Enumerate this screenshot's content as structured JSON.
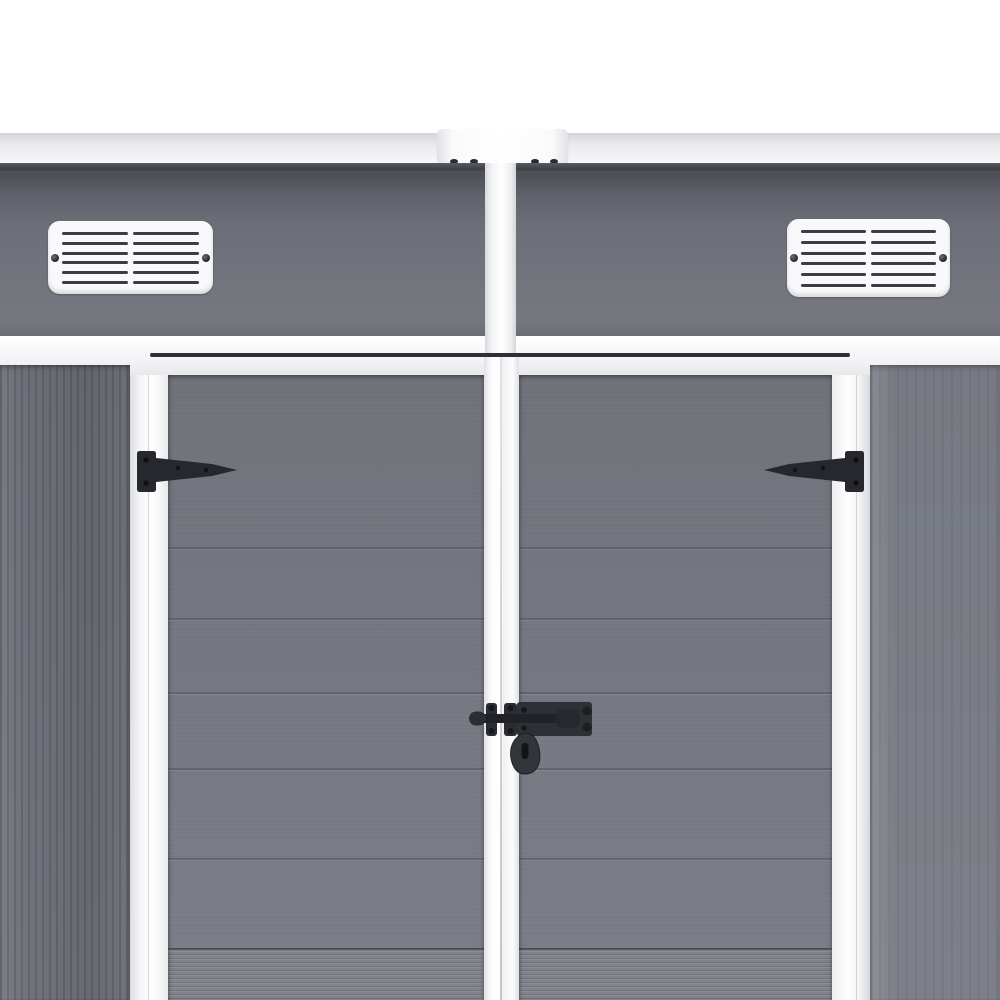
{
  "scene": {
    "subject": "garden-storage-shed-front",
    "view": "close-up of white-framed grey double doors with roof edge, two louvred vents, black tee hinges and black pad-bolt latch"
  },
  "colors": {
    "background": "#ffffff",
    "roof_strip_top": "#d6d6da",
    "roof_strip_bottom": "#f8f8fa",
    "connector_plate": "#fbfbfd",
    "shadow_line": "#3e4046",
    "upper_band_top": "#666972",
    "upper_band_bottom": "#75787f",
    "door_grey_top": "#6f7279",
    "door_grey_bottom": "#7b7e86",
    "trim_white": "#f8f8fa",
    "vent_white": "#f9f9fb",
    "vent_slat": "#3b3d41",
    "hardware_black": "#2a2c31",
    "hardware_dark": "#131417"
  },
  "roof": {
    "connector_screw_count": 4
  },
  "vents": {
    "count": 2,
    "slat_rows": 6,
    "slat_columns": 2,
    "screws_per_vent": 2
  },
  "doors": {
    "count": 2,
    "panel_top_y": 375,
    "groove_lines_y": [
      547,
      618,
      692,
      768,
      858,
      948
    ],
    "ribbed_band_top_y": 948
  },
  "hardware": {
    "hinge_count": 2,
    "latch_type": "pad-bolt-with-drop-handle"
  }
}
